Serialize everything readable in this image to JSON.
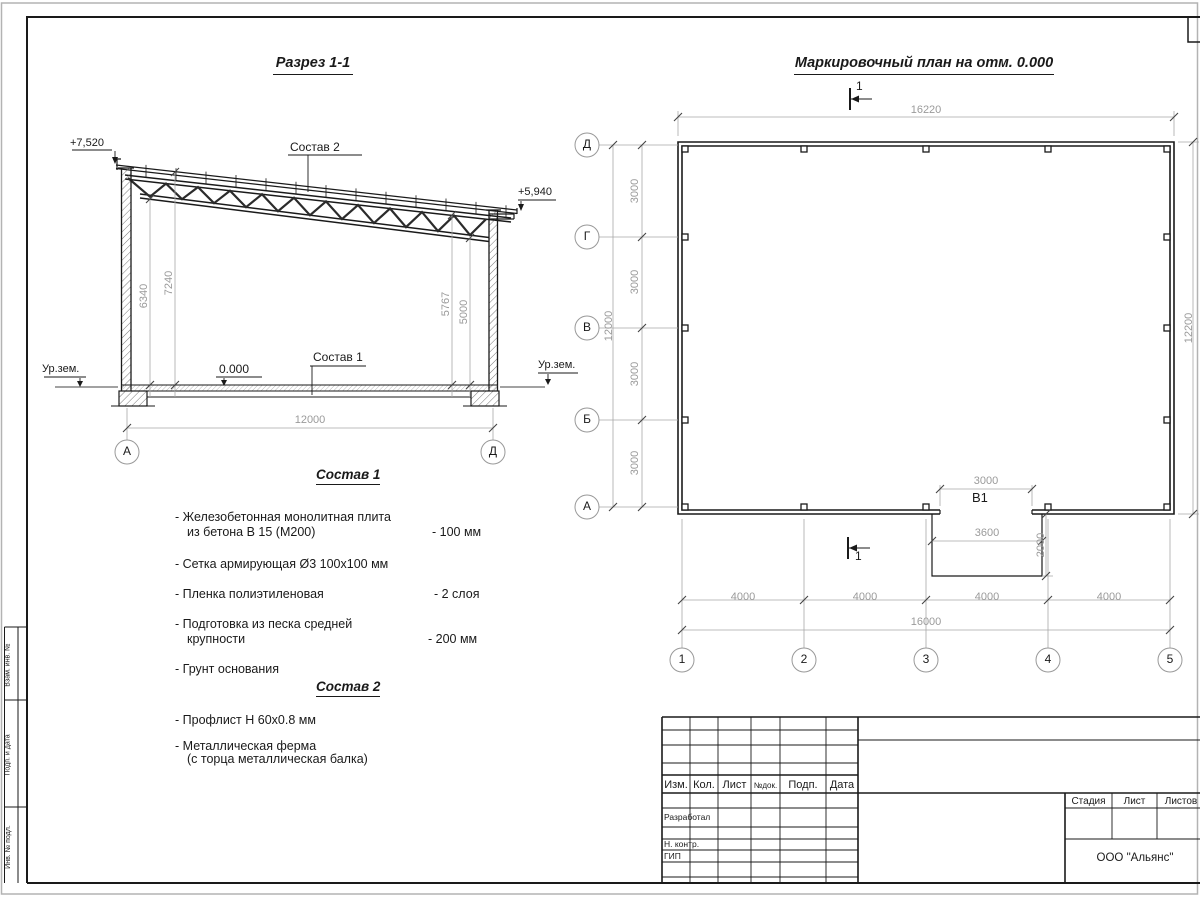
{
  "colors": {
    "line": "#1a1a1a",
    "dim_text": "#9a9a9a"
  },
  "section": {
    "title": "Разрез 1-1",
    "elev_top_left": "+7,520",
    "elev_top_right": "+5,940",
    "leader_roof": "Состав 2",
    "leader_floor": "Состав 1",
    "elev_floor": "0.000",
    "ground_left": "Ур.зем.",
    "ground_right": "Ур.зем.",
    "dim_h_7240": "7240",
    "dim_h_6340": "6340",
    "dim_h_5767": "5767",
    "dim_h_5000": "5000",
    "dim_span": "12000",
    "axis_left": "А",
    "axis_right": "Д"
  },
  "comp1": {
    "title": "Состав 1",
    "rows": [
      {
        "l1": "- Железобетонная  монолитная плита",
        "l2": "из бетона В 15 (М200)",
        "val": "- 100 мм"
      },
      {
        "l1": "- Сетка армирующая Ø3 100x100 мм",
        "l2": "",
        "val": ""
      },
      {
        "l1": "- Пленка полиэтиленовая",
        "l2": "",
        "val": "-  2 слоя"
      },
      {
        "l1": "- Подготовка из песка средней",
        "l2": "крупности",
        "val": "- 200 мм"
      },
      {
        "l1": "- Грунт основания",
        "l2": "",
        "val": ""
      }
    ]
  },
  "comp2": {
    "title": "Состав 2",
    "rows": [
      {
        "l1": "- Профлист Н 60x0.8 мм",
        "l2": ""
      },
      {
        "l1": "- Металлическая ферма",
        "l2": "(с торца металлическая балка)"
      }
    ]
  },
  "plan": {
    "title": "Маркировочный план на отм. 0.000",
    "cut_label": "1",
    "dim_top": "16220",
    "dim_right": "12200",
    "dim_left_total": "12000",
    "dim_left_segments": [
      "3000",
      "3000",
      "3000",
      "3000"
    ],
    "dim_bottom_segments": [
      "4000",
      "4000",
      "4000",
      "4000"
    ],
    "dim_bottom_total": "16000",
    "row_axes": [
      "Д",
      "Г",
      "В",
      "Б",
      "А"
    ],
    "col_axes": [
      "1",
      "2",
      "3",
      "4",
      "5"
    ],
    "door": {
      "label": "B1",
      "dim_opening": "3000",
      "dim_porch_width": "3600",
      "dim_porch_depth": "2000"
    }
  },
  "titleblock": {
    "cols": [
      "Изм.",
      "Кол.",
      "Лист",
      "№док.",
      "Подп.",
      "Дата"
    ],
    "row_labels": [
      "Разработал",
      "Н. контр.",
      "ГИП"
    ],
    "stage_cols": [
      "Стадия",
      "Лист",
      "Листов"
    ],
    "company": "ООО \"Альянс\""
  },
  "sidestamp": {
    "labels": [
      "Взам. инв. №",
      "Подп. и дата",
      "Инв. № подл."
    ]
  }
}
